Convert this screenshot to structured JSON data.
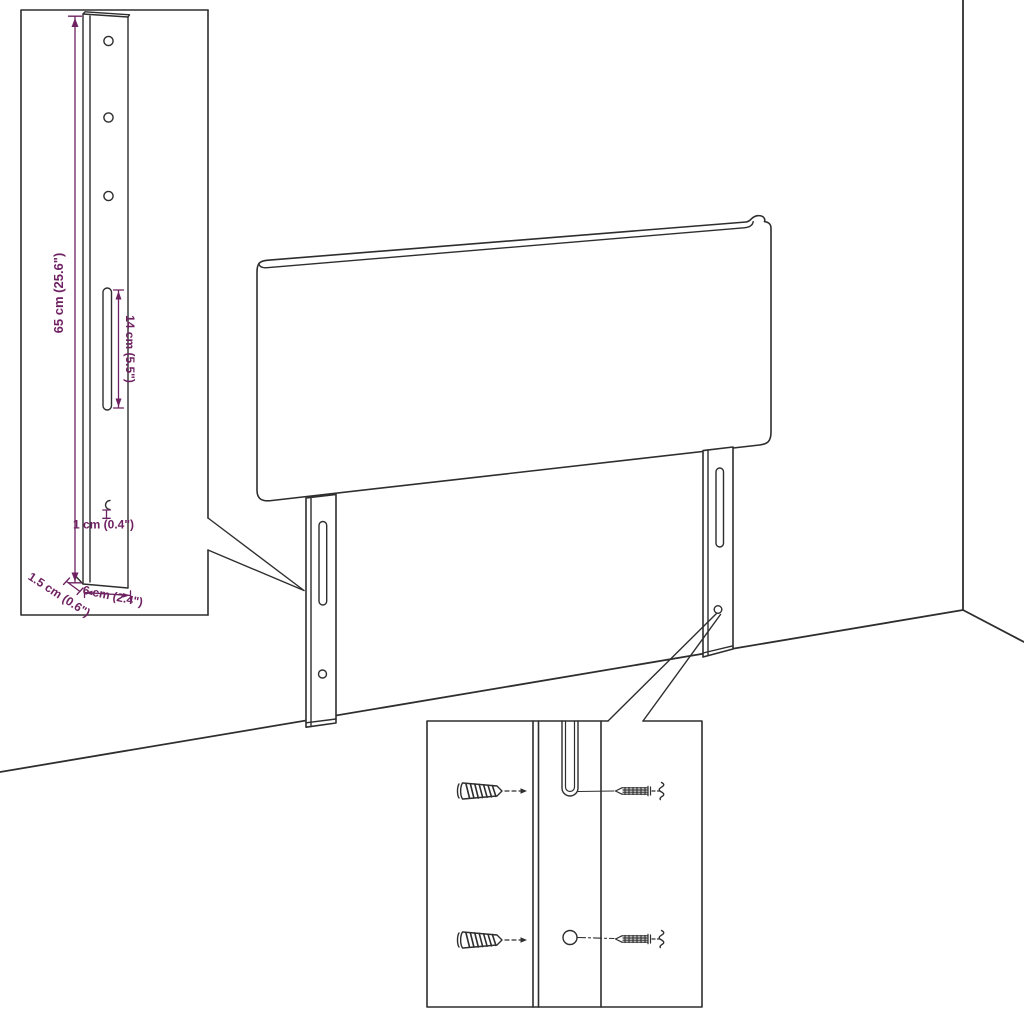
{
  "diagram": {
    "kind": "headboard-assembly-line-drawing",
    "dims": {
      "leg_height": "65 cm (25.6\")",
      "slot_length": "14 cm (5.5\")",
      "lip": "1 cm (0.4\")",
      "thickness": "1.5 cm (0.6\")",
      "leg_width": "6 cm (2.4\")"
    },
    "colors": {
      "line": "#2e2e2e",
      "dimension": "#6e2262",
      "background": "#ffffff"
    }
  }
}
